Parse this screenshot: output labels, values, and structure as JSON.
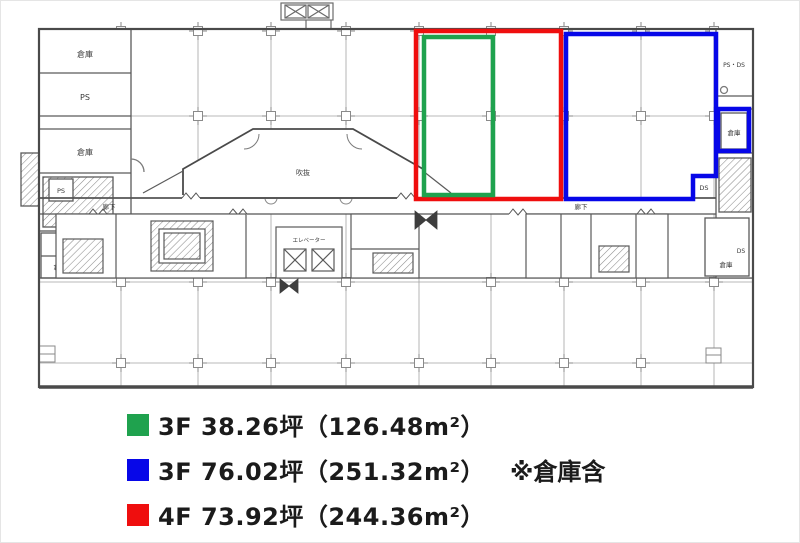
{
  "plan": {
    "labels": {
      "warehouse": "倉庫",
      "ps": "PS",
      "ps_ds": "PS・DS",
      "ds": "DS",
      "corridor": "廊下",
      "atrium": "吹抜",
      "elevator": "エレベーター"
    }
  },
  "legend": {
    "items": [
      {
        "floor": "3F",
        "color": "#1fa24e",
        "label": "3F 38.26坪（126.48m²）",
        "note": ""
      },
      {
        "floor": "3F",
        "color": "#0707e8",
        "label": "3F 76.02坪（251.32m²）",
        "note": "※倉庫含"
      },
      {
        "floor": "4F",
        "color": "#ef0e0e",
        "label": "4F 73.92坪（244.36m²）",
        "note": ""
      }
    ]
  }
}
